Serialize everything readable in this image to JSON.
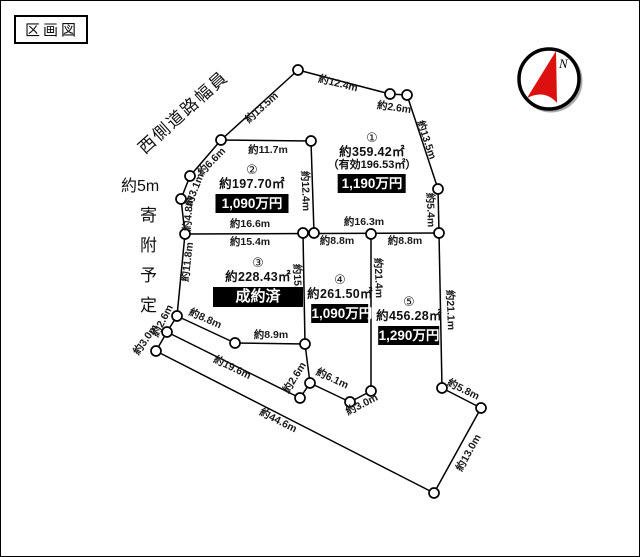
{
  "title": "区画図",
  "compass": {
    "label": "N",
    "needle_color": "#dd1010"
  },
  "annotations": {
    "west_road_label": "西側道路幅員",
    "road_width": "約5m",
    "donation": "寄附予定"
  },
  "colors": {
    "line": "#000000",
    "price_box_bg": "#000000",
    "price_box_text": "#ffffff"
  },
  "lots": [
    {
      "num": "①",
      "area": "約359.42㎡",
      "sub": "（有効196.53㎡）",
      "price": "1,190万円",
      "cx": 371,
      "top": 130,
      "box_w": 68
    },
    {
      "num": "②",
      "area": "約197.70㎡",
      "price": "1,090万円",
      "cx": 251,
      "top": 162,
      "box_w": 73
    },
    {
      "num": "③",
      "area": "約228.43㎡",
      "status": "成約済",
      "cx": 257,
      "top": 255,
      "box_w": 90
    },
    {
      "num": "④",
      "area": "約261.50㎡",
      "price": "1,090万円",
      "cx": 339,
      "top": 272,
      "box_w": 57
    },
    {
      "num": "⑤",
      "area": "約456.28㎡",
      "price": "1,290万円",
      "cx": 408,
      "top": 294,
      "box_w": 61
    }
  ],
  "dimensions": [
    {
      "t": "約13.5m",
      "x": 261,
      "y": 107,
      "r": -42
    },
    {
      "t": "約12.4m",
      "x": 337,
      "y": 83,
      "r": 14
    },
    {
      "t": "約2.6m",
      "x": 393,
      "y": 107,
      "r": 8
    },
    {
      "t": "約13.5m",
      "x": 425,
      "y": 139,
      "r": 71
    },
    {
      "t": "約5.4m",
      "x": 429,
      "y": 209,
      "r": 88
    },
    {
      "t": "約21.1m",
      "x": 449,
      "y": 309,
      "r": 88
    },
    {
      "t": "約5.8m",
      "x": 462,
      "y": 389,
      "r": 26
    },
    {
      "t": "約13.0m",
      "x": 468,
      "y": 452,
      "r": -61
    },
    {
      "t": "約44.6m",
      "x": 277,
      "y": 420,
      "r": 27
    },
    {
      "t": "約19.6m",
      "x": 231,
      "y": 367,
      "r": 26
    },
    {
      "t": "約8.8m",
      "x": 204,
      "y": 318,
      "r": 24
    },
    {
      "t": "約8.9m",
      "x": 270,
      "y": 334,
      "r": 0
    },
    {
      "t": "約11.8m",
      "x": 187,
      "y": 261,
      "r": -83
    },
    {
      "t": "約2.6m",
      "x": 162,
      "y": 320,
      "r": -63
    },
    {
      "t": "約3.0m",
      "x": 145,
      "y": 339,
      "r": -55
    },
    {
      "t": "約4.8m",
      "x": 188,
      "y": 213,
      "r": -85
    },
    {
      "t": "約3.1m",
      "x": 194,
      "y": 189,
      "r": -68
    },
    {
      "t": "約6.6m",
      "x": 211,
      "y": 161,
      "r": -46
    },
    {
      "t": "約11.7m",
      "x": 267,
      "y": 149,
      "r": 0
    },
    {
      "t": "約12.4m",
      "x": 304,
      "y": 190,
      "r": 88
    },
    {
      "t": "約16.6m",
      "x": 249,
      "y": 223,
      "r": 0
    },
    {
      "t": "約15.4m",
      "x": 249,
      "y": 241,
      "r": 0
    },
    {
      "t": "約15.0m",
      "x": 296,
      "y": 283,
      "r": 88
    },
    {
      "t": "約8.8m",
      "x": 336,
      "y": 240,
      "r": 0
    },
    {
      "t": "約16.3m",
      "x": 363,
      "y": 221,
      "r": 0
    },
    {
      "t": "約8.8m",
      "x": 404,
      "y": 240,
      "r": 0
    },
    {
      "t": "約21.4m",
      "x": 377,
      "y": 277,
      "r": 88
    },
    {
      "t": "約2.6m",
      "x": 294,
      "y": 377,
      "r": -58
    },
    {
      "t": "約6.1m",
      "x": 331,
      "y": 378,
      "r": 25
    },
    {
      "t": "約3.0m",
      "x": 361,
      "y": 404,
      "r": -27
    }
  ],
  "geometry": {
    "segments": [
      [
        220,
        139,
        297,
        69
      ],
      [
        297,
        69,
        389,
        93
      ],
      [
        389,
        93,
        406,
        94
      ],
      [
        406,
        94,
        437,
        188
      ],
      [
        437,
        188,
        438,
        232
      ],
      [
        438,
        232,
        441,
        387
      ],
      [
        441,
        387,
        480,
        407
      ],
      [
        480,
        407,
        433,
        492
      ],
      [
        433,
        492,
        155,
        350
      ],
      [
        155,
        350,
        166,
        331
      ],
      [
        166,
        331,
        176,
        315
      ],
      [
        176,
        315,
        184,
        233
      ],
      [
        184,
        233,
        180,
        198
      ],
      [
        180,
        198,
        189,
        175
      ],
      [
        189,
        175,
        220,
        139
      ],
      [
        220,
        139,
        310,
        140
      ],
      [
        310,
        140,
        313,
        232
      ],
      [
        184,
        233,
        438,
        232
      ],
      [
        302,
        232,
        304,
        343
      ],
      [
        304,
        343,
        234,
        342
      ],
      [
        234,
        342,
        176,
        315
      ],
      [
        370,
        233,
        370,
        390
      ],
      [
        370,
        390,
        349,
        401
      ],
      [
        349,
        401,
        309,
        382
      ],
      [
        309,
        382,
        299,
        397
      ],
      [
        299,
        397,
        166,
        331
      ],
      [
        304,
        343,
        309,
        382
      ]
    ],
    "vertices": [
      [
        220,
        139
      ],
      [
        297,
        69
      ],
      [
        389,
        93
      ],
      [
        406,
        94
      ],
      [
        437,
        188
      ],
      [
        438,
        232
      ],
      [
        441,
        387
      ],
      [
        480,
        407
      ],
      [
        433,
        492
      ],
      [
        155,
        350
      ],
      [
        166,
        331
      ],
      [
        176,
        315
      ],
      [
        184,
        233
      ],
      [
        180,
        198
      ],
      [
        189,
        175
      ],
      [
        310,
        140
      ],
      [
        302,
        232
      ],
      [
        313,
        232
      ],
      [
        370,
        233
      ],
      [
        370,
        390
      ],
      [
        349,
        401
      ],
      [
        309,
        382
      ],
      [
        299,
        397
      ],
      [
        304,
        343
      ],
      [
        234,
        342
      ]
    ]
  }
}
